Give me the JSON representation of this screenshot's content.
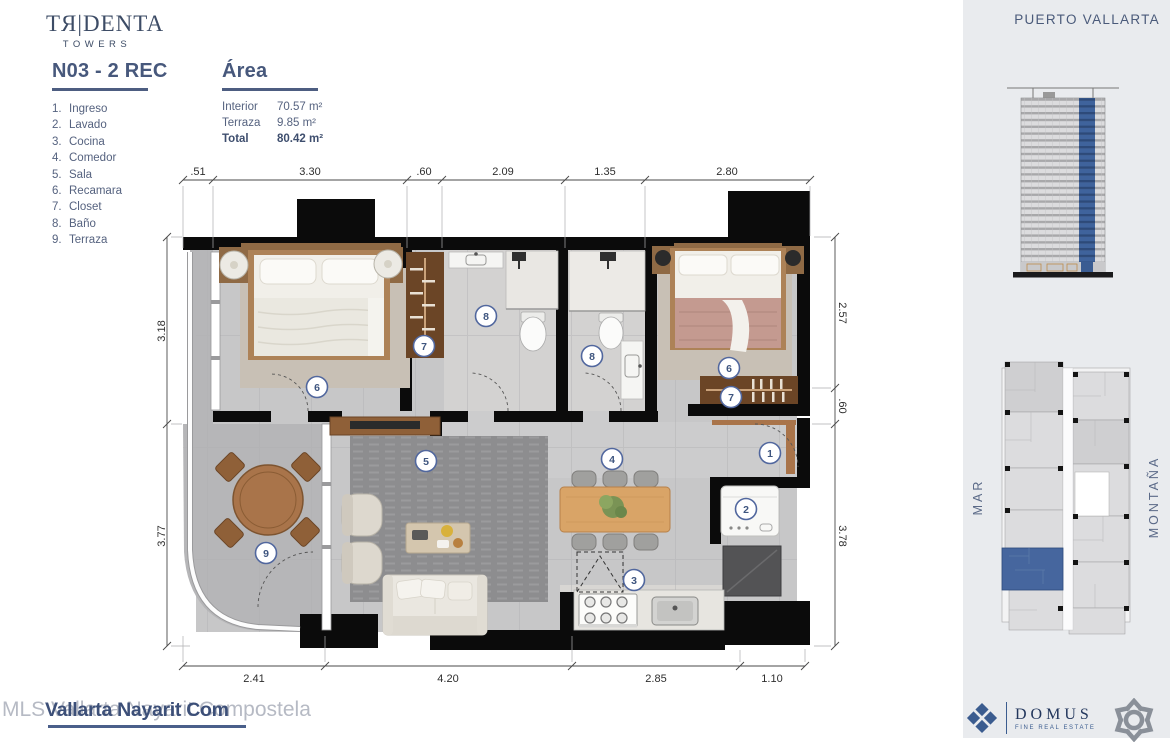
{
  "brand": {
    "logo_main": "TЯ|DENTA",
    "logo_sub": "TOWERS"
  },
  "unit": {
    "title": "N03 - 2 REC"
  },
  "legend": {
    "items": [
      {
        "num": "1.",
        "label": "Ingreso"
      },
      {
        "num": "2.",
        "label": "Lavado"
      },
      {
        "num": "3.",
        "label": "Cocina"
      },
      {
        "num": "4.",
        "label": "Comedor"
      },
      {
        "num": "5.",
        "label": "Sala"
      },
      {
        "num": "6.",
        "label": "Recamara"
      },
      {
        "num": "7.",
        "label": "Closet"
      },
      {
        "num": "8.",
        "label": "Baño"
      },
      {
        "num": "9.",
        "label": "Terraza"
      }
    ]
  },
  "area": {
    "title": "Área",
    "rows": [
      {
        "label": "Interior",
        "value": "70.57 m²"
      },
      {
        "label": "Terraza",
        "value": "9.85 m²"
      },
      {
        "label": "Total",
        "value": "80.42 m²"
      }
    ]
  },
  "location": {
    "city": "PUERTO VALLARTA"
  },
  "keyplan": {
    "sea_label": "MAR",
    "mountain_label": "MONTAÑA"
  },
  "plan": {
    "dims_top": [
      ".51",
      "3.30",
      ".60",
      "2.09",
      "1.35",
      "2.80"
    ],
    "dims_bottom": [
      "2.41",
      "4.20",
      "2.85",
      "1.10"
    ],
    "dims_left": [
      "3.18",
      "3.77"
    ],
    "dims_right": [
      "2.57",
      ".60",
      "3.78"
    ],
    "markers": [
      {
        "label": "6"
      },
      {
        "label": "7"
      },
      {
        "label": "8"
      },
      {
        "label": "8"
      },
      {
        "label": "6"
      },
      {
        "label": "7"
      },
      {
        "label": "1"
      },
      {
        "label": "2"
      },
      {
        "label": "4"
      },
      {
        "label": "5"
      },
      {
        "label": "3"
      },
      {
        "label": "9"
      }
    ]
  },
  "footer": {
    "watermark": "MLS Vallarta Nayarit Compostela",
    "listing_title": "Vallarta Nayarit Com"
  },
  "logos": {
    "domus_name": "DOMUS",
    "domus_tagline": "FINE REAL ESTATE"
  },
  "colors": {
    "brand_navy": "#47587c",
    "panel_bg": "#e9ebee",
    "marker_blue": "#4a639a",
    "unit_highlight": "#46669e",
    "domus_blue": "#3b5c8f",
    "partner_gray": "#8a9099",
    "wood": "#a9744a"
  }
}
